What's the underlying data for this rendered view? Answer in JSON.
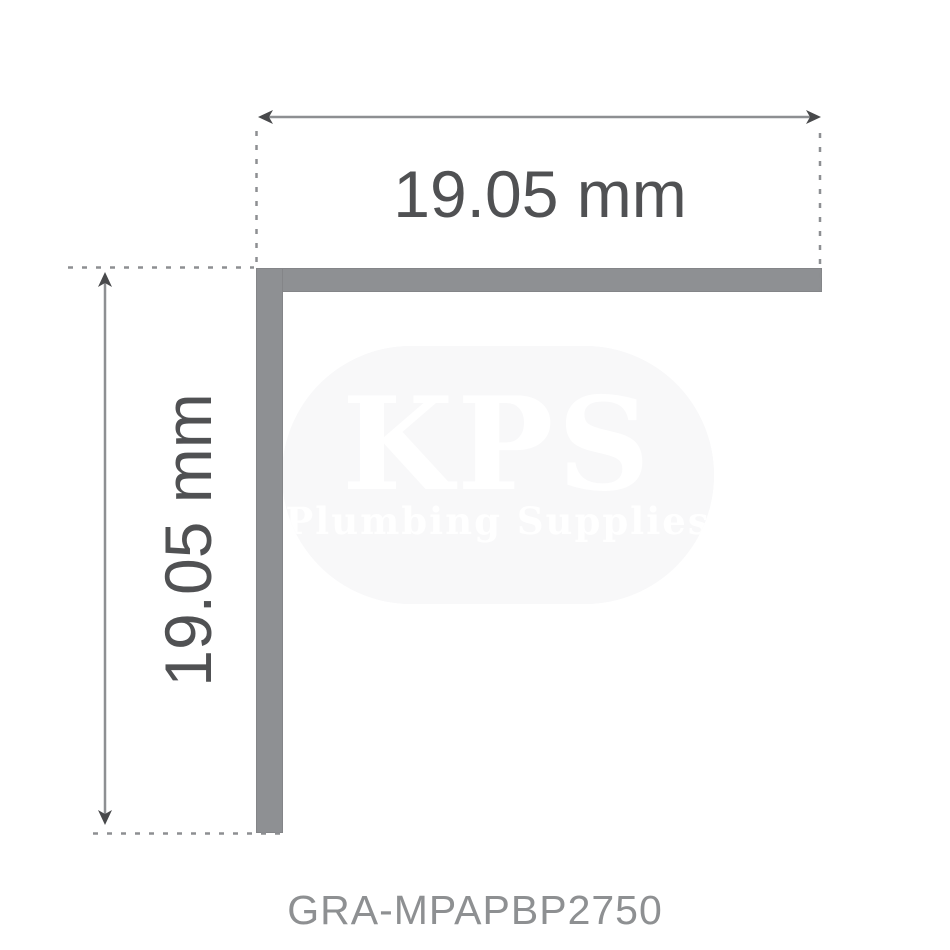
{
  "diagram": {
    "top_dimension_label": "19.05 mm",
    "left_dimension_label": "19.05 mm",
    "product_code": "GRA-MPAPBP2750",
    "shape": "L-angle profile"
  },
  "watermark": {
    "title": "KPS",
    "subtitle": "Plumbing Supplies"
  },
  "colors": {
    "background": "#ffffff",
    "profile": "#8e9093",
    "dimension_line": "#8d8f92",
    "arrow": "#48494b",
    "label_text": "#505153",
    "code_text": "#8e9092",
    "watermark_bg": "#f2f2f4",
    "watermark_text": "#ffffff"
  }
}
